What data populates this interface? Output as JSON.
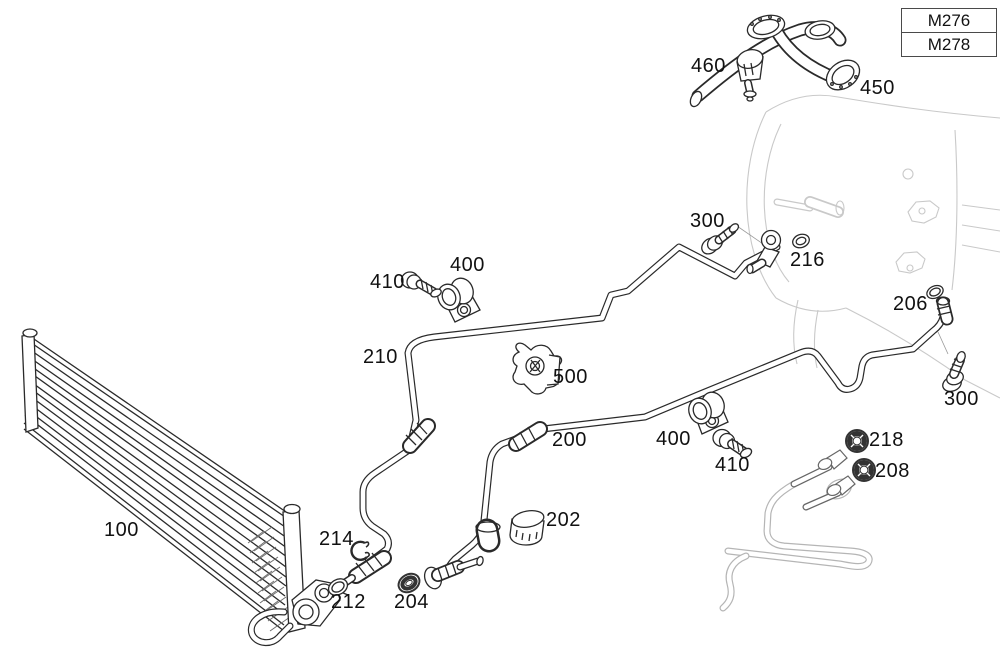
{
  "diagram_type": "exploded-parts-diagram",
  "subject": "transmission-oil-cooler-lines",
  "colors": {
    "background": "#ffffff",
    "main_line": "#2a2a2a",
    "context_line": "#c9c9c9",
    "label_text": "#111111",
    "legend_border": "#4a4a4a"
  },
  "legend": {
    "entries": [
      {
        "code": "M276"
      },
      {
        "code": "M278"
      }
    ]
  },
  "parts": [
    {
      "ref": "100"
    },
    {
      "ref": "200"
    },
    {
      "ref": "202"
    },
    {
      "ref": "204"
    },
    {
      "ref": "206"
    },
    {
      "ref": "208"
    },
    {
      "ref": "210"
    },
    {
      "ref": "212"
    },
    {
      "ref": "214"
    },
    {
      "ref": "216"
    },
    {
      "ref": "218"
    },
    {
      "ref": "300"
    },
    {
      "ref": "300"
    },
    {
      "ref": "400"
    },
    {
      "ref": "400"
    },
    {
      "ref": "410"
    },
    {
      "ref": "410"
    },
    {
      "ref": "450"
    },
    {
      "ref": "460"
    },
    {
      "ref": "500"
    }
  ]
}
